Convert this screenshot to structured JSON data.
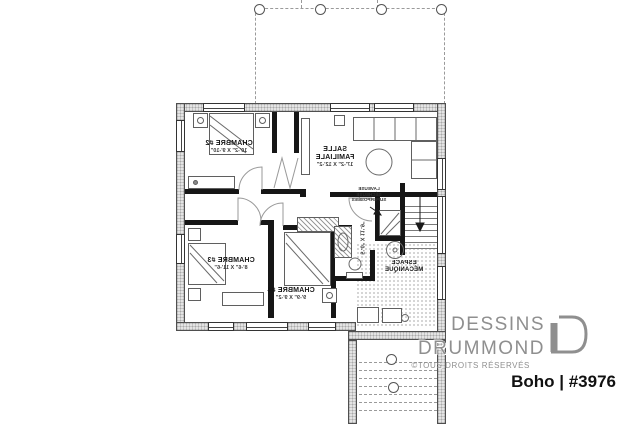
{
  "note": "reversed (mirrored) basement floor plan print",
  "branding": {
    "name_line1": "DESSINS",
    "name_line2": "DRUMMOND",
    "copyright": "©TOUS DROITS RÉSERVÉS",
    "plan_label": "Boho | #3976",
    "logo_color": "#8f8f8f",
    "plan_label_color": "#111111"
  },
  "rooms": {
    "chambre2": {
      "name": "CHAMBRE #2",
      "dims": "10'-2\" X 9'-10\""
    },
    "salle_familiale": {
      "name_line1": "SALLE",
      "name_line2": "FAMILIALE",
      "dims": "17'-2\" X 12'-2\""
    },
    "chambre3": {
      "name": "CHAMBRE #3",
      "dims": "8'-6\" X 11'-6\""
    },
    "chambre4": {
      "name": "CHAMBRE #4",
      "dims": "9'-9\" X 9'-2\""
    },
    "salle_de_bain": {
      "dims": "5'-0\" X 11'-9\""
    },
    "espace_mecanique": {
      "name_line1": "ESPACE",
      "name_line2": "MÉCANIQUE"
    },
    "laundry": {
      "line1": "LAVEUSE",
      "line2": "SÉCHEUSE",
      "line3": "SUPERPOSÉES"
    }
  },
  "plan_colors": {
    "exterior_wall_fill": "#e4e4e4",
    "wall_line": "#4f4f4f",
    "interior_wall": "#161616"
  }
}
